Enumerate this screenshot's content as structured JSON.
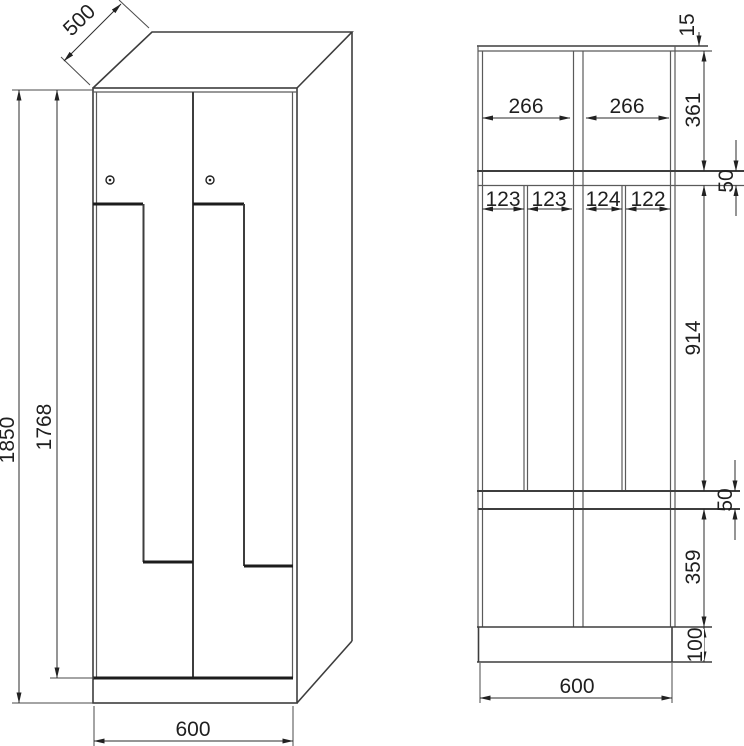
{
  "drawing": {
    "type": "technical-dimension-drawing",
    "subject": "Z-door locker cabinet, front view and vertical cross-section",
    "colors": {
      "line": "#3d3d3d",
      "thick_line": "#1c1c1c",
      "text": "#1f1f1f",
      "background": "#ffffff"
    },
    "front_view": {
      "depth": "500",
      "total_height": "1850",
      "door_height": "1768",
      "width": "600"
    },
    "section_view": {
      "top_panel_gap": "15",
      "upper_compartment_height": "361",
      "upper_compartment_width_left": "266",
      "upper_compartment_width_right": "266",
      "upper_shelf_thickness": "50",
      "main_compartment_height": "914",
      "column_widths": [
        "123",
        "123",
        "124",
        "122"
      ],
      "lower_shelf_thickness": "50",
      "lower_compartment_height": "359",
      "plinth_height": "100",
      "width": "600"
    }
  }
}
